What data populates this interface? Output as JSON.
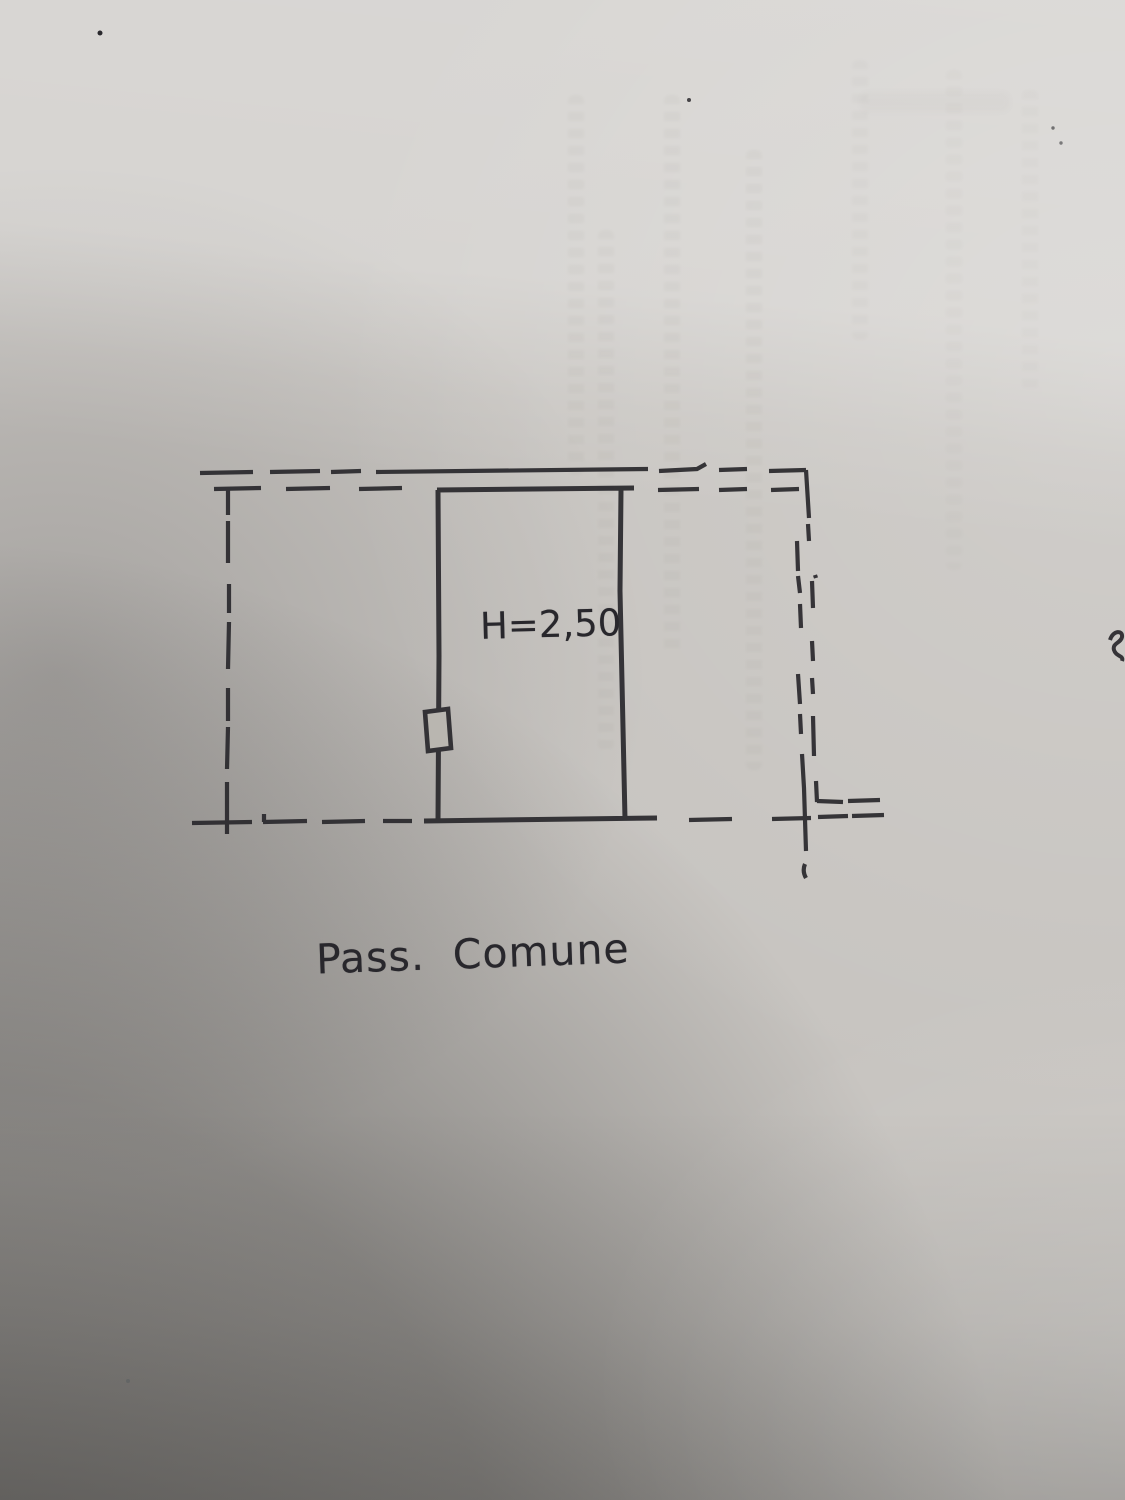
{
  "plan": {
    "room_height_label": "H=2,50",
    "caption": "Pass. Comune"
  },
  "colors": {
    "paper_base": "#c7c4c0",
    "ink": "#2a292d"
  }
}
